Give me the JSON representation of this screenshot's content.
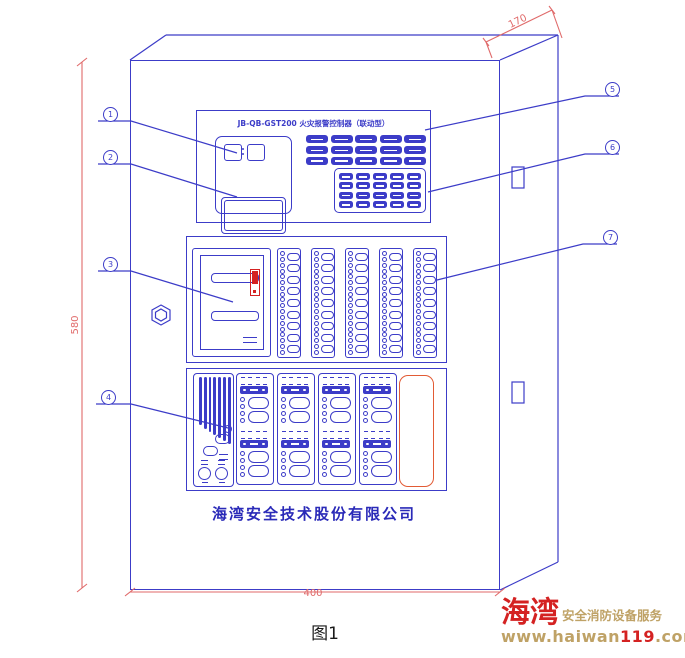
{
  "drawing": {
    "model_title": "JB-QB-GST200 火灾报警控制器（联动型）",
    "company_name": "海湾安全技术股份有限公司",
    "figure_caption": "图1",
    "dimensions": {
      "top": "170",
      "left": "580",
      "bottom": "400"
    },
    "callouts": [
      "1",
      "2",
      "3",
      "4",
      "5",
      "6",
      "7"
    ],
    "colors": {
      "line_blue": "#3c3cc8",
      "dim_red": "#e06a6a",
      "alarm_red": "#d42222",
      "accent_orange": "#e25b35",
      "logo_tan": "#bfa266"
    }
  },
  "watermark": {
    "brand": "海湾",
    "tagline": "安全消防设备服务",
    "url_prefix": "www.haiwan",
    "url_highlight": "119",
    "url_suffix": ".com"
  },
  "panel_config": {
    "indicator_grid": {
      "rows": 3,
      "cols": 5
    },
    "keypad": {
      "rows": 4,
      "cols": 5
    },
    "light_strips": {
      "count": 5,
      "rows": 9
    },
    "control_columns": {
      "count": 4,
      "modules": 2
    },
    "speaker_bar_heights": [
      48,
      52,
      55,
      58,
      61,
      64,
      67
    ]
  }
}
